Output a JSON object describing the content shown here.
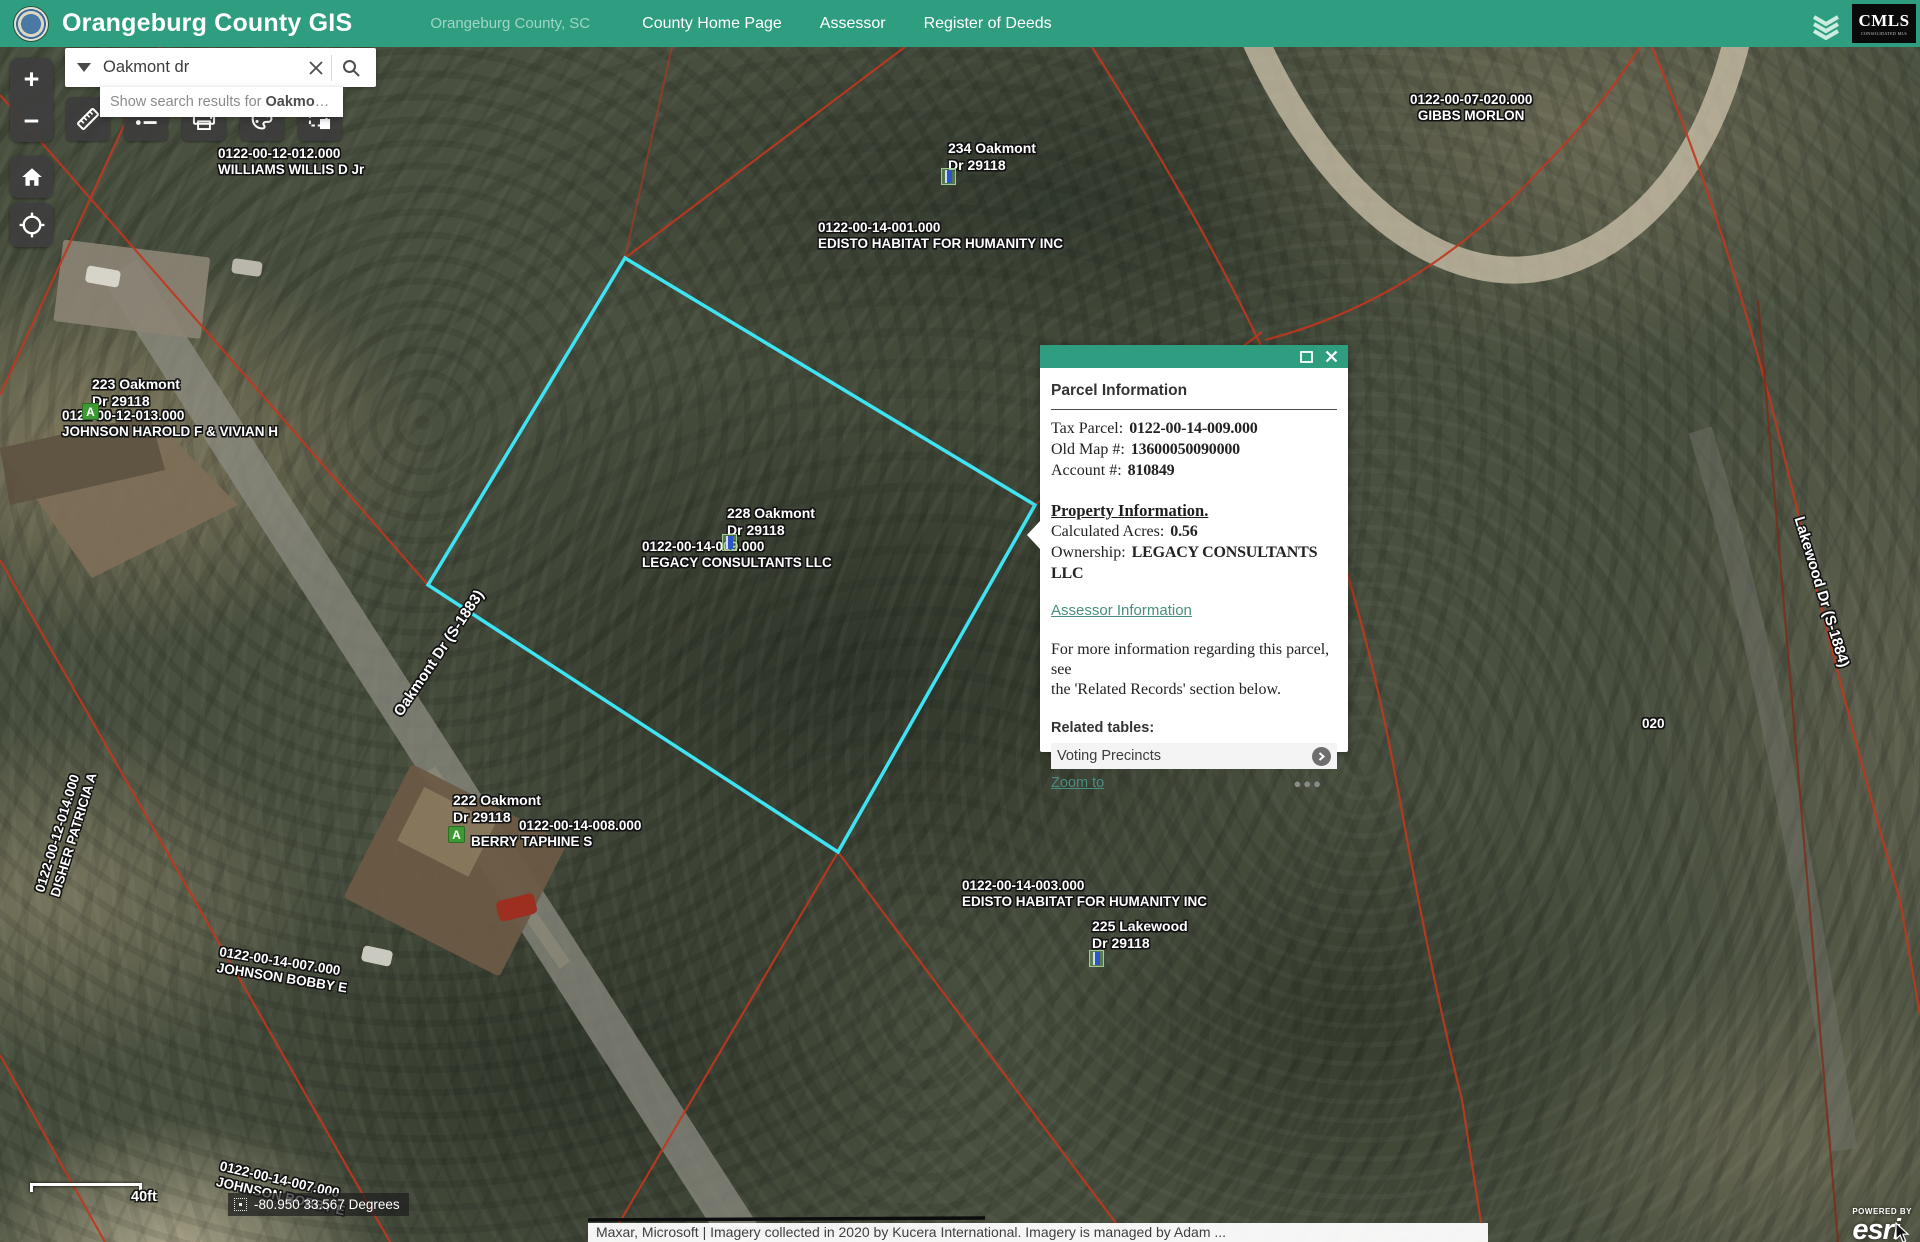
{
  "header": {
    "app_title": "Orangeburg County GIS",
    "location_subtitle": "Orangeburg County, SC",
    "nav_items": [
      "County Home Page",
      "Assessor",
      "Register of Deeds"
    ],
    "cmls_logo_text": "CMLS",
    "cmls_logo_subtext": "CONSOLIDATED MLS",
    "brand_color": "#2f9d80"
  },
  "search": {
    "value": "Oakmont dr",
    "suggestion_prefix": "Show search results for",
    "suggestion_term": "Oakmo",
    "suggestion_suffix": "…"
  },
  "map_controls": {
    "zoom_in": "+",
    "zoom_out": "−"
  },
  "popup": {
    "title": "Parcel Information",
    "fields": [
      {
        "label": "Tax Parcel:",
        "value": "0122-00-14-009.000"
      },
      {
        "label": "Old Map #:",
        "value": "13600050090000"
      },
      {
        "label": "Account #:",
        "value": "810849"
      }
    ],
    "section_heading": "Property Information.",
    "property_fields": [
      {
        "label": "Calculated Acres:",
        "value": "0.56"
      },
      {
        "label": "Ownership:",
        "value": "LEGACY CONSULTANTS LLC"
      }
    ],
    "assessor_link": "Assessor Information",
    "note_line1": "For more information regarding this parcel, see",
    "note_line2": "the 'Related Records' section below.",
    "related_heading": "Related tables:",
    "related_item": "Voting Precincts",
    "zoom_link": "Zoom to",
    "more_label": "●●●"
  },
  "markers": {
    "address_glyph": "A"
  },
  "map_labels": [
    {
      "lines": [
        "0122-00-12-012.000",
        "WILLIAMS WILLIS D Jr"
      ]
    },
    {
      "lines": [
        "234 Oakmont",
        "Dr 29118"
      ]
    },
    {
      "lines": [
        "0122-00-14-001.000",
        "EDISTO HABITAT FOR HUMANITY INC"
      ]
    },
    {
      "lines": [
        "0122-00-07-020.000",
        "GIBBS MORLON"
      ]
    },
    {
      "lines": [
        "223 Oakmont",
        "Dr 29118"
      ]
    },
    {
      "lines": [
        "0122-00-12-013.000",
        "JOHNSON HAROLD F & VIVIAN H"
      ]
    },
    {
      "lines": [
        "228 Oakmont",
        "Dr 29118"
      ]
    },
    {
      "lines": [
        "0122-00-14-009.000",
        "LEGACY CONSULTANTS LLC"
      ]
    },
    {
      "lines": [
        "Oakmont Dr (S-1883)"
      ]
    },
    {
      "lines": [
        "Lakewood Dr (S-1884)"
      ]
    },
    {
      "lines": [
        "0122-00-12-014.000",
        "DISHER PATRICIA A"
      ]
    },
    {
      "lines": [
        "222 Oakmont",
        "Dr 29118"
      ]
    },
    {
      "lines": [
        "0122-00-14-008.000",
        "BERRY TAPHINE S"
      ]
    },
    {
      "lines": [
        "0122-00-14-003.000",
        "EDISTO HABITAT FOR HUMANITY INC"
      ]
    },
    {
      "lines": [
        "225 Lakewood",
        "Dr 29118"
      ]
    },
    {
      "lines": [
        "0122-00-14-007.000",
        "JOHNSON BOBBY E"
      ]
    },
    {
      "lines": [
        "0122-00-14-007.000",
        "JOHNSON BOBBY E"
      ]
    },
    {
      "lines": [
        "020"
      ]
    }
  ],
  "scalebar": {
    "label": "40ft"
  },
  "coordinates": {
    "value": "-80.950 33.567 Degrees"
  },
  "attribution": {
    "text": "Maxar, Microsoft | Imagery collected in 2020 by Kucera International. Imagery is managed by Adam ...",
    "powered_by": "POWERED BY",
    "esri_logo": "esri"
  }
}
